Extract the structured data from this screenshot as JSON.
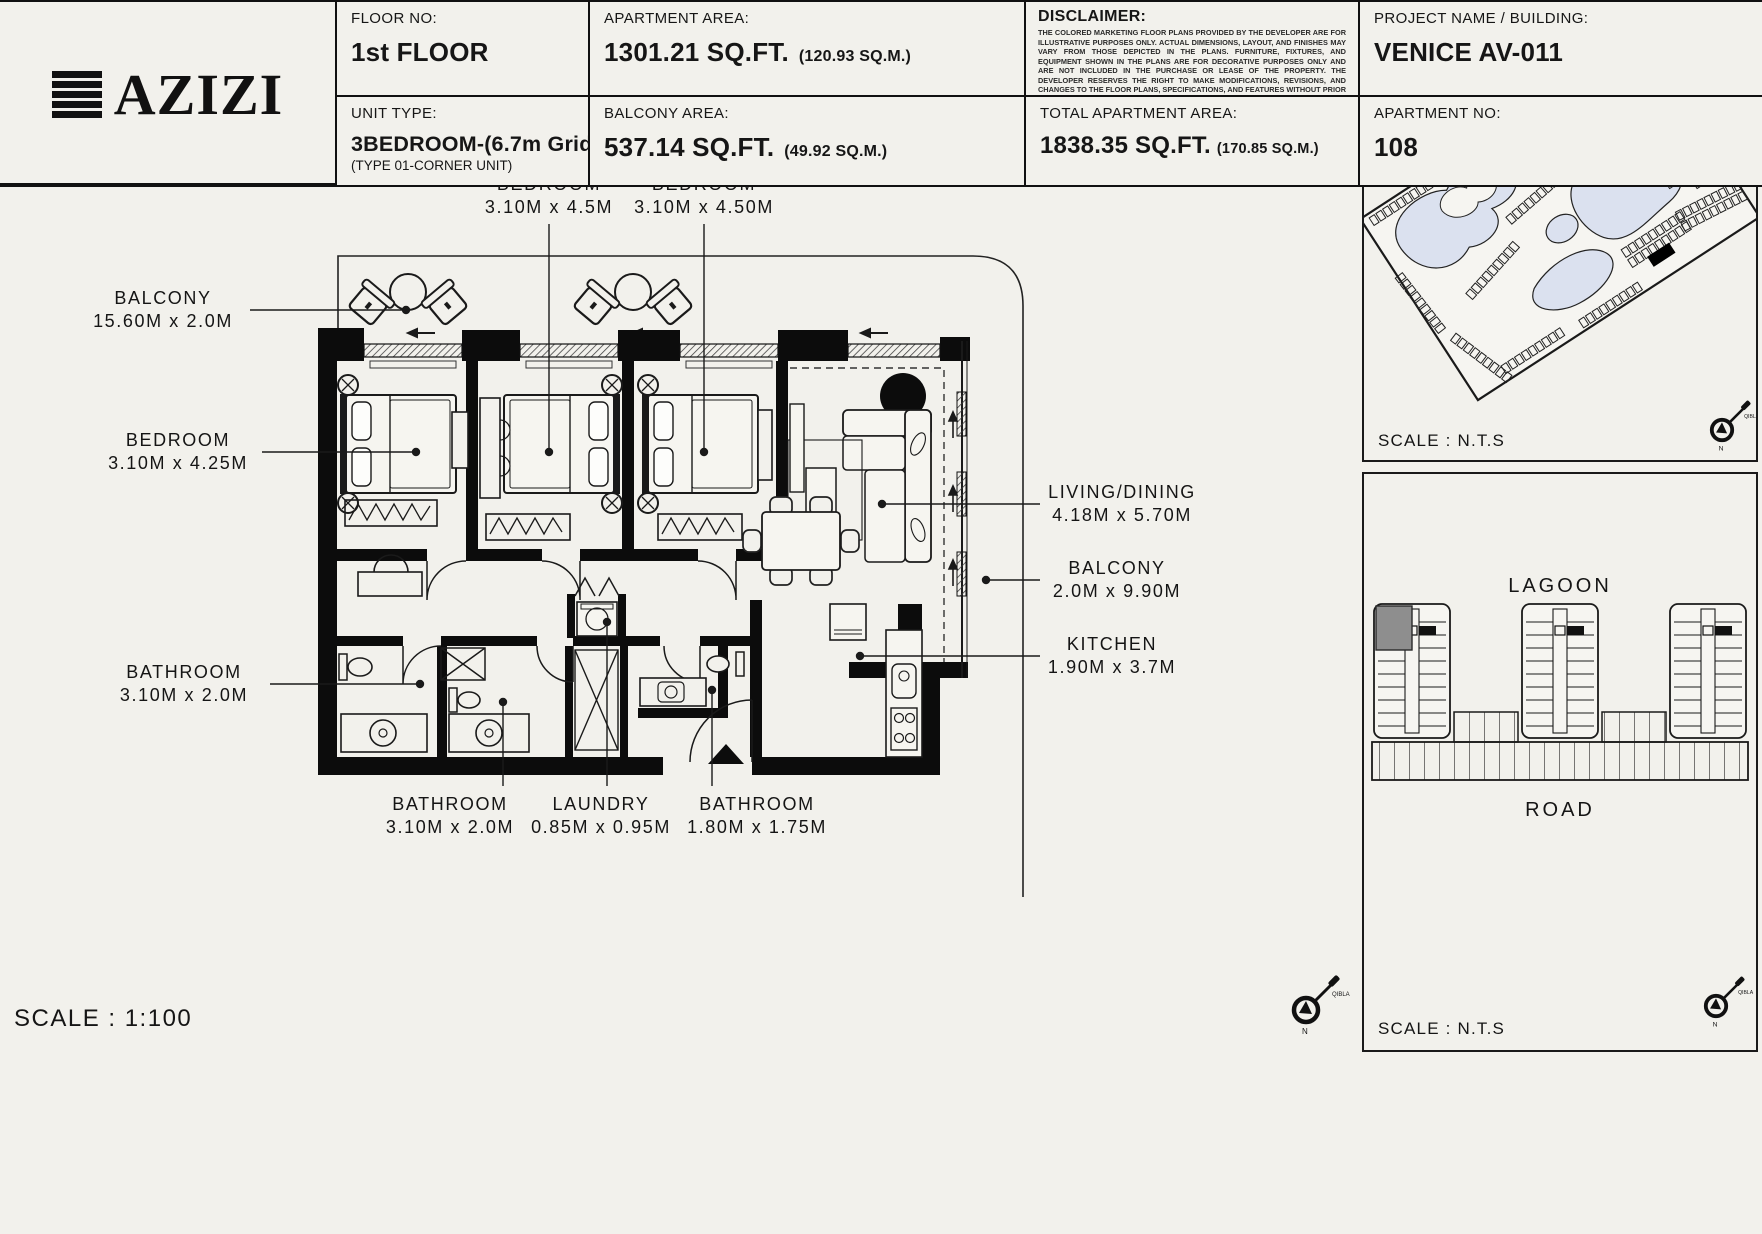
{
  "plan": {
    "scale": "SCALE : 1:100",
    "balcony_top": [
      "BALCONY",
      "15.60M x 2.0M"
    ],
    "bedroom_left": [
      "BEDROOM",
      "3.10M x 4.25M"
    ],
    "bathroom_left": [
      "BATHROOM",
      "3.10M x 2.0M"
    ],
    "bedroom_top1": [
      "BEDROOM",
      "3.10M x 4.5M"
    ],
    "bedroom_top2": [
      "BEDROOM",
      "3.10M x 4.50M"
    ],
    "living": [
      "LIVING/DINING",
      "4.18M x 5.70M"
    ],
    "balcony_right": [
      "BALCONY",
      "2.0M x 9.90M"
    ],
    "kitchen": [
      "KITCHEN",
      "1.90M x 3.7M"
    ],
    "bathroom_b1": [
      "BATHROOM",
      "3.10M x 2.0M"
    ],
    "laundry": [
      "LAUNDRY",
      "0.85M x 0.95M"
    ],
    "bathroom_b2": [
      "BATHROOM",
      "1.80M x 1.75M"
    ]
  },
  "compass": {
    "n": "N",
    "qibla": "QIBLA"
  },
  "sitemap": {
    "scale": "SCALE : N.T.S",
    "water_color": "#dbe1ef"
  },
  "keyplan": {
    "scale": "SCALE : N.T.S",
    "lagoon": "LAGOON",
    "road": "ROAD",
    "highlight_color": "#8e8e8e"
  },
  "info": {
    "brand": "AZIZI",
    "floor_no": {
      "label": "FLOOR NO:",
      "value": "1st FLOOR"
    },
    "unit_type": {
      "label": "UNIT TYPE:",
      "value": "3BEDROOM-(6.7m Grid)",
      "note": "(TYPE 01-CORNER UNIT)"
    },
    "apartment_area": {
      "label": "APARTMENT AREA:",
      "value": "1301.21 SQ.FT.",
      "metric": "(120.93 SQ.M.)"
    },
    "balcony_area": {
      "label": "BALCONY AREA:",
      "value": "537.14 SQ.FT.",
      "metric": "(49.92 SQ.M.)"
    },
    "disclaimer": {
      "label": "DISCLAIMER:",
      "text": "THE COLORED MARKETING FLOOR PLANS PROVIDED BY THE DEVELOPER ARE FOR ILLUSTRATIVE PURPOSES ONLY. ACTUAL DIMENSIONS, LAYOUT, AND FINISHES MAY VARY FROM THOSE DEPICTED IN THE PLANS. FURNITURE, FIXTURES, AND EQUIPMENT SHOWN IN THE PLANS ARE FOR DECORATIVE PURPOSES ONLY AND ARE NOT INCLUDED IN THE PURCHASE OR LEASE OF THE PROPERTY. THE DEVELOPER RESERVES THE RIGHT TO MAKE MODIFICATIONS, REVISIONS, AND CHANGES TO THE FLOOR PLANS, SPECIFICATIONS, AND FEATURES WITHOUT PRIOR NOTICE."
    },
    "total_area": {
      "label": "TOTAL APARTMENT AREA:",
      "value": "1838.35 SQ.FT.",
      "metric": "(170.85 SQ.M.)"
    },
    "project": {
      "label": "PROJECT NAME / BUILDING:",
      "value": "VENICE  AV-011"
    },
    "apartment_no": {
      "label": "APARTMENT NO:",
      "value": "108"
    }
  }
}
